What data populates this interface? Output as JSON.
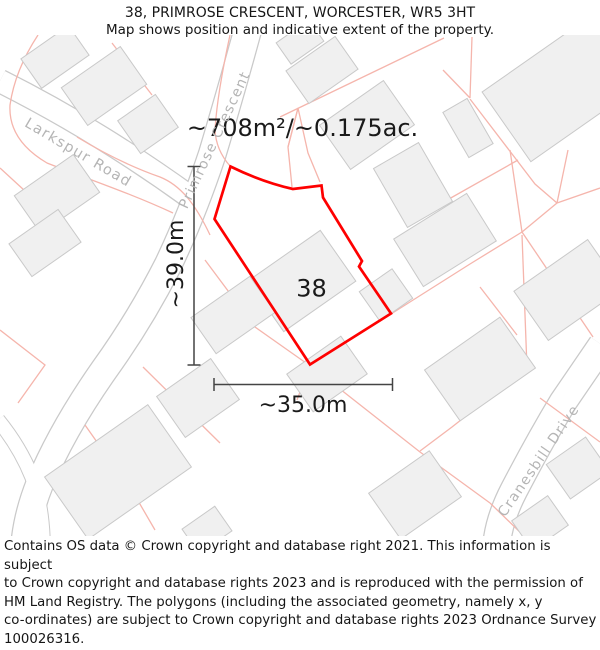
{
  "header": {
    "title": "38, PRIMROSE CRESCENT, WORCESTER, WR5 3HT",
    "subtitle": "Map shows position and indicative extent of the property."
  },
  "map": {
    "area_label": "~708m²/~0.175ac.",
    "plot_number": "38",
    "height_dimension": "~39.0m",
    "width_dimension": "~35.0m",
    "roads": [
      {
        "name": "Larkspur Road"
      },
      {
        "name": "Primrose Crescent"
      },
      {
        "name": "Cranesbill Drive"
      }
    ],
    "colors": {
      "property_outline": "#fe0000",
      "parcel_line": "#f5b5ac",
      "road_casing": "#c9c9c9",
      "road_fill": "#ffffff",
      "building_fill": "#f0f0f0",
      "building_stroke": "#c9c9c9",
      "dimension_line": "#444444",
      "road_label": "#b5b5b5"
    }
  },
  "footer": {
    "lines": [
      "Contains OS data © Crown copyright and database right 2021. This information is subject",
      "to Crown copyright and database rights 2023 and is reproduced with the permission of",
      "HM Land Registry. The polygons (including the associated geometry, namely x, y",
      "co-ordinates) are subject to Crown copyright and database rights 2023 Ordnance Survey",
      "100026316."
    ]
  }
}
